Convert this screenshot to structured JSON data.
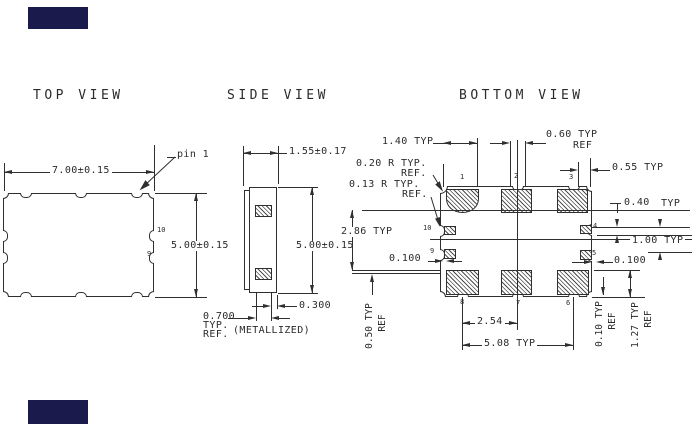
{
  "redactions": {
    "color": "#1a1a4d"
  },
  "views": {
    "top": {
      "title": "TOP VIEW",
      "dim_width": "7.00±0.15",
      "dim_height": "5.00±0.15",
      "pin1": "pin 1",
      "pin10": "10",
      "pin9": "9"
    },
    "side": {
      "title": "SIDE VIEW",
      "dim_width": "1.55±0.17",
      "dim_height": "5.00±0.15",
      "dim_pad_inset": "0.300",
      "dim_pad_width": "0.700",
      "typ": "TYP.",
      "ref": "REF.",
      "metallized": "(METALLIZED)"
    },
    "bottom": {
      "title": "BOTTOM VIEW",
      "dim_pad_w": "1.40 TYP",
      "dim_notch_w": "0.60 TYP",
      "dim_notch_w_ref": "REF",
      "radius1": "0.20 R TYP.",
      "radius1_ref": "REF.",
      "radius2": "0.13 R TYP.",
      "radius2_ref": "REF.",
      "dim_edge": "0.55 TYP",
      "dim_side_pad_h": "0.40",
      "dim_side_pad_h_typ": "TYP",
      "dim_side_pitch": "1.00 TYP",
      "dim_clear_left": "0.100",
      "dim_clear_right": "0.100",
      "dim_span": "2.86 TYP",
      "dim_pitch": "2.54",
      "dim_row": "5.08 TYP",
      "dim_050": "0.50 TYP",
      "dim_050_ref": "REF",
      "dim_010": "0.10 TYP",
      "dim_010_ref": "REF",
      "dim_127": "1.27 TYP",
      "dim_127_ref": "REF",
      "pads": {
        "p1": "1",
        "p2": "2",
        "p3": "3",
        "p4": "4",
        "p5": "5",
        "p6": "6",
        "p7": "7",
        "p8": "8",
        "p9": "9",
        "p10": "10"
      }
    }
  }
}
